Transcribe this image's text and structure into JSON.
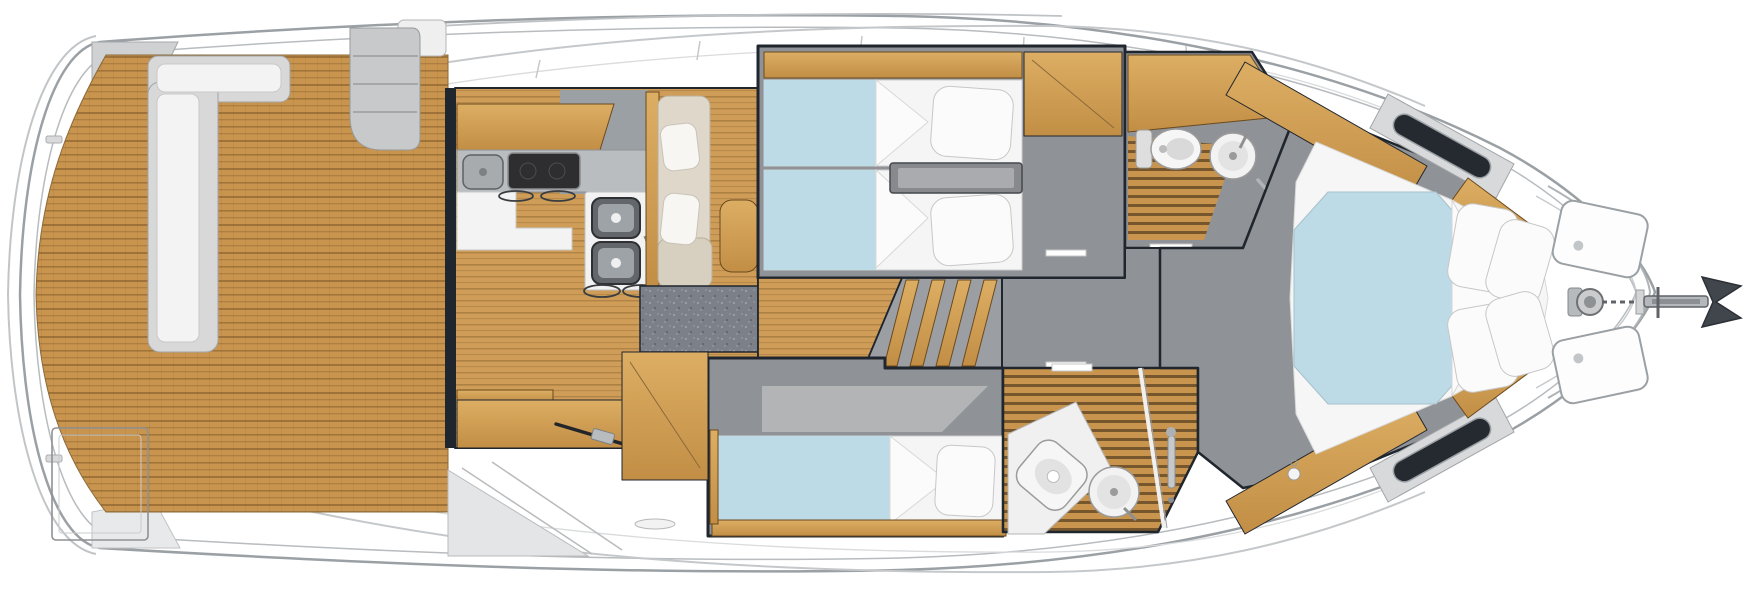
{
  "page": {
    "title": "Motor yacht interior floor plan — top-down deck view, bow to the right",
    "type": "boat-floorplan",
    "orientation": {
      "bow": "right",
      "stern": "left"
    }
  },
  "colors": {
    "hull": "#ffffff",
    "outline": "#9aa0a4",
    "dark_wall": "#20262e",
    "teak": "#c9954e",
    "teak_seam": "#7a5526",
    "wood_floor": "#cf9d57",
    "wood_light": "#dcae63",
    "wood_dark": "#c28e45",
    "wood_edge": "#6b4a1e",
    "floor_gray": "#8f9296",
    "counter_gray": "#babdbf",
    "carpet": "#7b8089",
    "bed_blue": "#bcdbe6",
    "linen": "#f7f7f7",
    "steel": "#9aa0a4",
    "stove": "#2e2e31"
  },
  "areas": [
    {
      "id": "aft-deck",
      "name": "Aft cockpit with teak deck, L-shaped bench and deck hatch"
    },
    {
      "id": "salon-galley",
      "name": "Salon and galley with stove, sinks and cabinets"
    },
    {
      "id": "dinette",
      "name": "Dinette bench with cushions and table"
    },
    {
      "id": "twin-cabin",
      "name": "Guest cabin with two twin berths"
    },
    {
      "id": "day-head",
      "name": "Guest bathroom with toilet and round washbasin"
    },
    {
      "id": "companionway",
      "name": "Companionway stairs and lower-deck corridor"
    },
    {
      "id": "single-cabin",
      "name": "Guest cabin with single berth"
    },
    {
      "id": "shower-room",
      "name": "Shower room with toilet, washbasin and teak grating"
    },
    {
      "id": "master-cabin",
      "name": "Forward master cabin with island double berth and hull windows"
    },
    {
      "id": "bow-deck",
      "name": "Foredeck with deck hatches, windlass, chain and anchor"
    },
    {
      "id": "hull",
      "name": "Hull outline, side decks, rails and swim platform"
    }
  ],
  "fixtures": [
    "l-shaped-cockpit-bench",
    "flybridge-steps",
    "cockpit-deck-hatch",
    "sliding-door-track",
    "galley-breakfast-bar",
    "galley-hand-sink",
    "two-burner-stove",
    "double-stainless-sink",
    "bar-stools",
    "dinette-table",
    "twin-berth",
    "bedside-shelf",
    "wardrobe",
    "toilet",
    "round-washbasin",
    "towel-bar",
    "companionway-steps",
    "single-berth",
    "shower-column",
    "island-double-berth",
    "bed-pillow",
    "hull-window",
    "foredeck-hatch",
    "anchor-windlass",
    "anchor-chain",
    "anchor"
  ]
}
